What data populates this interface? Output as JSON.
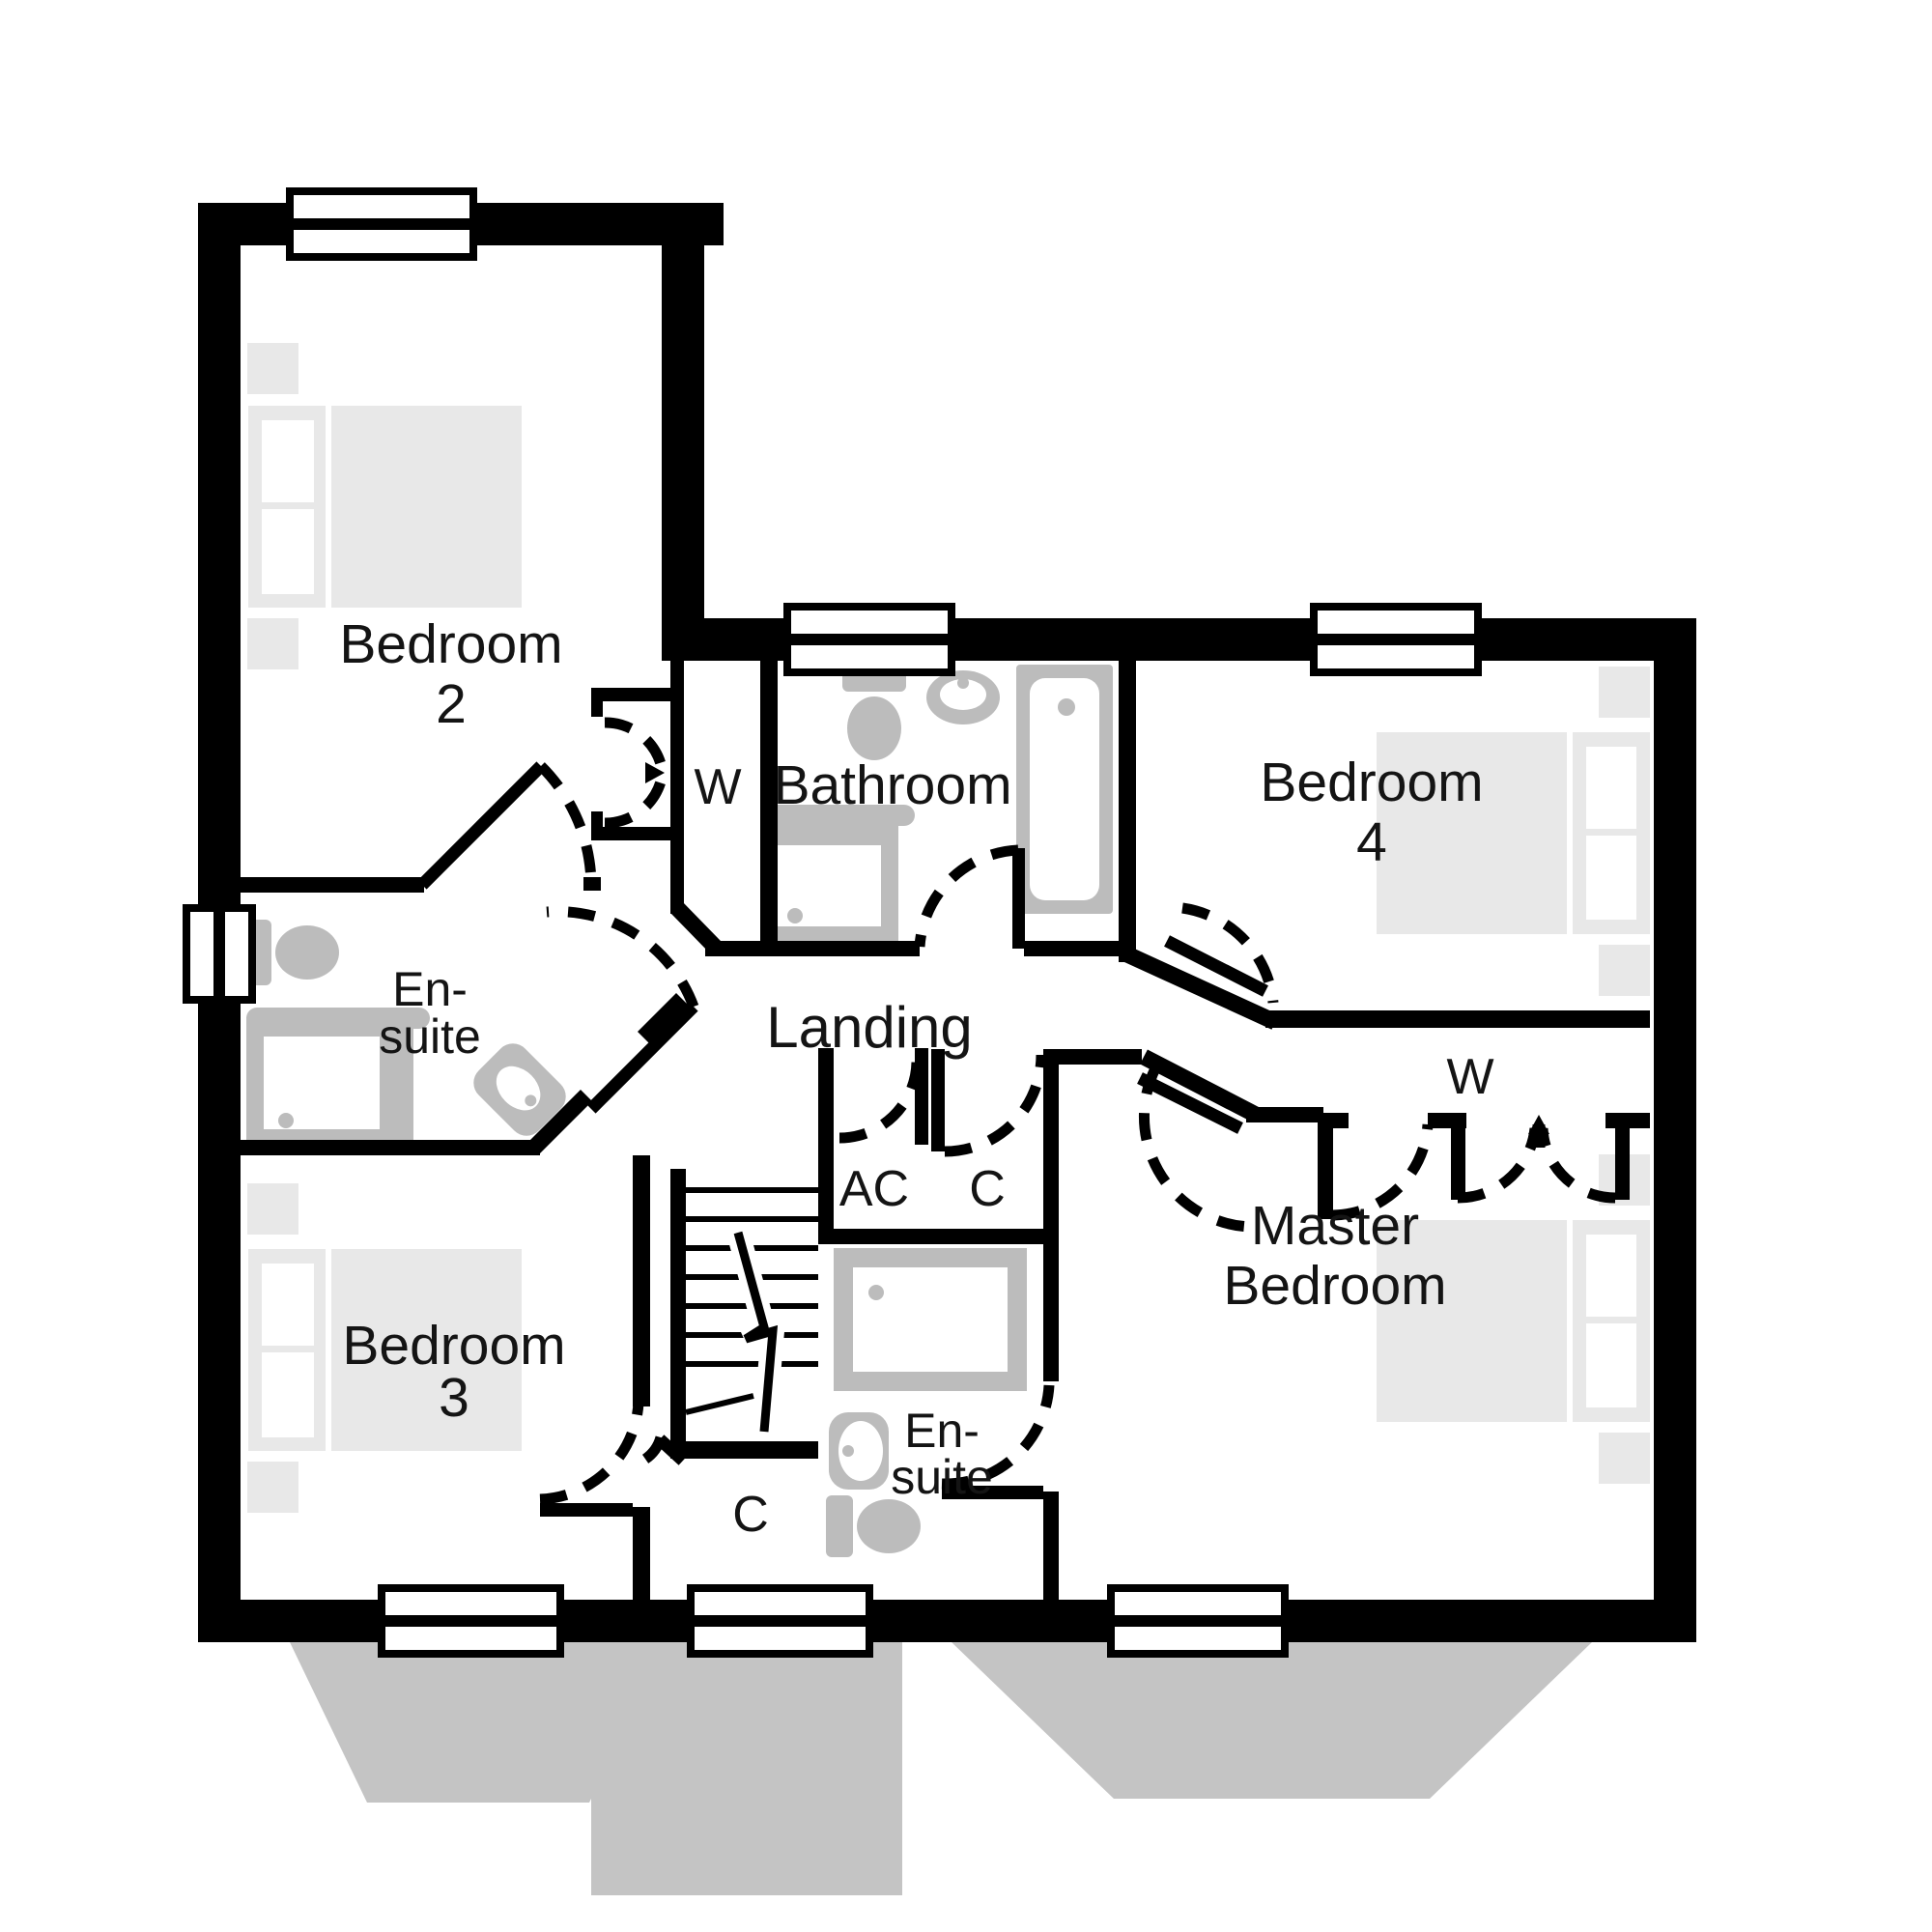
{
  "title": "First floor plan",
  "colors": {
    "wall": "#000000",
    "fixture": "#bcbcbc",
    "furniture": "#e8e8e8",
    "ground": "#c4c4c4",
    "background": "#ffffff"
  },
  "labels": {
    "bedroom2": [
      "Bedroom",
      "2"
    ],
    "bathroom": "Bathroom",
    "bedroom4": [
      "Bedroom",
      "4"
    ],
    "ensuite1": [
      "En-",
      "suite"
    ],
    "wardrobe_bedroom2": "W",
    "landing": "Landing",
    "wardrobe_master": "W",
    "bedroom3": [
      "Bedroom",
      "3"
    ],
    "airing_cupboard": "AC",
    "cupboard_landing": "C",
    "master_bedroom": [
      "Master",
      "Bedroom"
    ],
    "ensuite_master": [
      "En-",
      "suite"
    ],
    "cupboard_stairs": "C"
  }
}
